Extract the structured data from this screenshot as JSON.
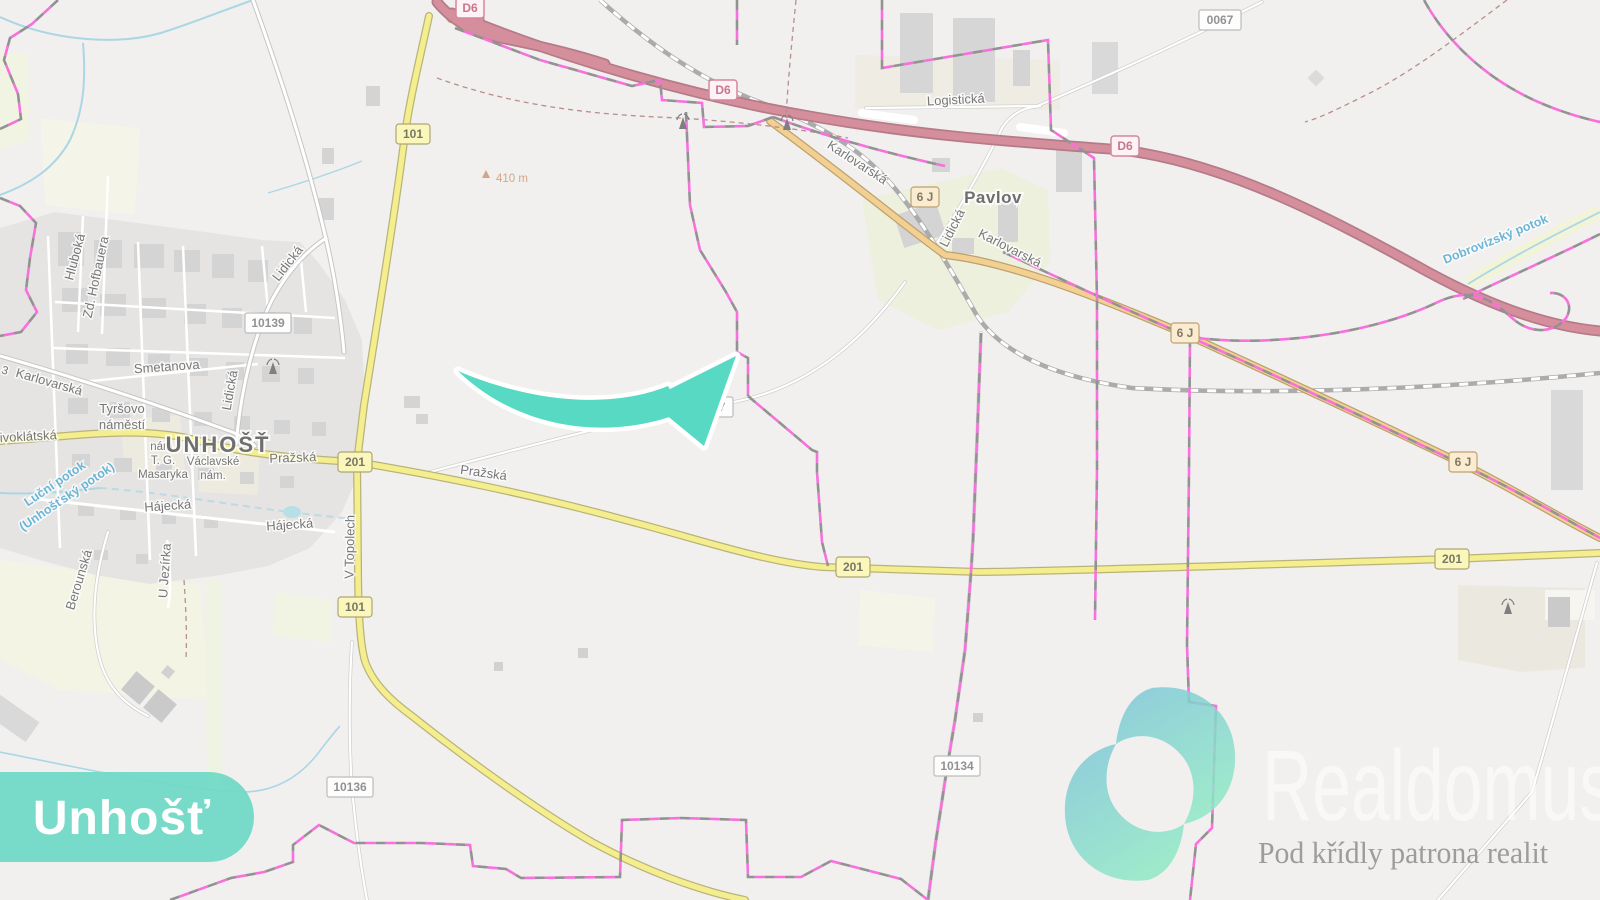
{
  "map": {
    "towns": {
      "unhost": "UNHOŠŤ",
      "pavlov": "Pavlov"
    },
    "streets": {
      "hluboka": "Hluboká",
      "zd_hofbauera": "Zd. Hofbauera",
      "lidicka": "Lidická",
      "smetanova": "Smetanova",
      "karlovarska": "Karlovarská",
      "tyrsovo_1": "Tyršovo",
      "tyrsovo_2": "náměstí",
      "krivoklatska": "Křivoklátská",
      "nam_1": "nám.",
      "nam_2": "T. G.",
      "nam_3": "Masaryka",
      "vaclavske_1": "Václavské",
      "vaclavske_2": "nám.",
      "prazska": "Pražská",
      "hajecka": "Hájecká",
      "berounska": "Berounská",
      "u_jezirka": "U Jezírka",
      "v_topolech": "V Topolech",
      "logisticka": "Logistická",
      "fragment_3": "3"
    },
    "waters": {
      "lucni_1": "Luční potok",
      "lucni_2": "(Unhošťský potok)",
      "dobrovizsky": "Dobrovízský potok"
    },
    "shields": {
      "d6": "D6",
      "r101": "101",
      "r201": "201",
      "r6j": "6 J",
      "r0067": "0067",
      "r10139": "10139",
      "r10134": "10134",
      "r10136": "10136"
    },
    "elevation": "410 m"
  },
  "overlay": {
    "badge": "Unhošť",
    "logo_brand": "Realdomus",
    "logo_tagline": "Pod křídly patrona realit"
  },
  "colors": {
    "accent_teal": "#57d9c3",
    "boundary_magenta": "#f73fd3",
    "road_motorway": "#c6697b",
    "road_primary": "#eec06d",
    "road_secondary": "#f2e968",
    "water_blue": "#8fc8dd"
  }
}
